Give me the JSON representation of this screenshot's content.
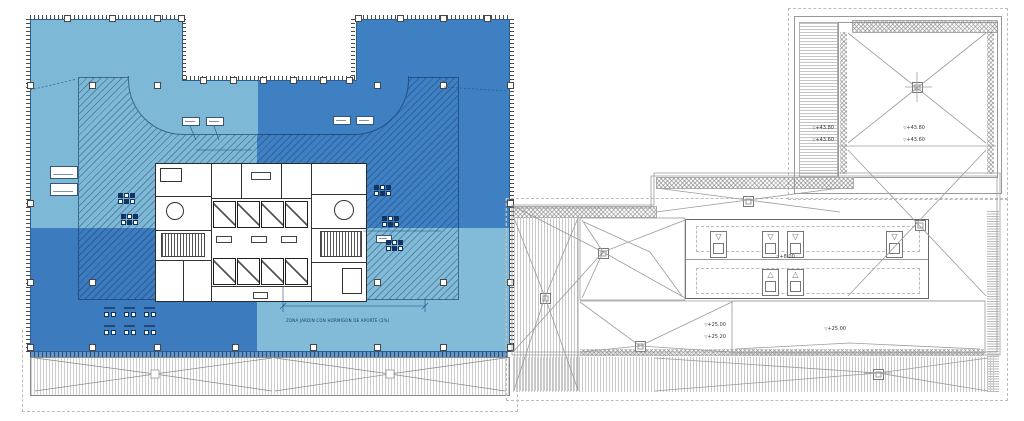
{
  "drawing": {
    "levels": {
      "louver_line1": "+43.80",
      "louver_line2": "+43.60",
      "upper_square_line1": "+43.80",
      "upper_square_line2": "+43.60",
      "slab_left_line1": "+25.00",
      "slab_left_line2": "+25.20",
      "slab_right": "+25.00",
      "plant": "+8.00"
    },
    "notes": {
      "garden": "ZONA JARDIN CON HORMIGON DE APORTE (2%)"
    },
    "icons": {
      "level_marker": "▽"
    },
    "colors": {
      "quad_light_tl": "#7db9d6",
      "quad_dark_tr": "#3f80c3",
      "quad_dark_bl": "#3c7bbe",
      "quad_light_br": "#82bbd7",
      "hatch_line": "#10325c",
      "line_gray": "#9b9b9b",
      "edge_dark": "#4a4a4a"
    }
  }
}
